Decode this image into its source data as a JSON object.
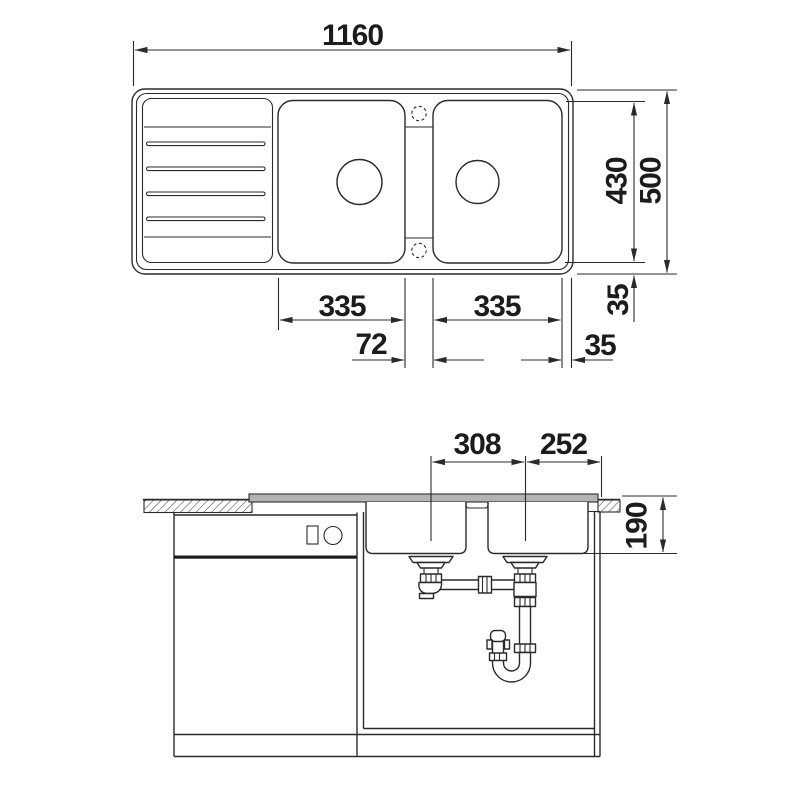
{
  "drawing": {
    "type": "kitchen-sink-installation-drawing",
    "views": [
      "top-view",
      "section-view"
    ],
    "units": "mm"
  },
  "colors": {
    "line": "#2a2a2a",
    "background": "#ffffff",
    "rim_fill": "#b4b4b4"
  },
  "dims": {
    "overall_width": "1160",
    "depth_inner": "430",
    "depth_overall": "500",
    "bowl1_width": "335",
    "bowl2_width": "335",
    "divider_width": "72",
    "rim_right": "35",
    "rim_bottom": "35",
    "drain_spacing": "308",
    "drain_to_edge": "252",
    "bowl_depth": "190"
  }
}
